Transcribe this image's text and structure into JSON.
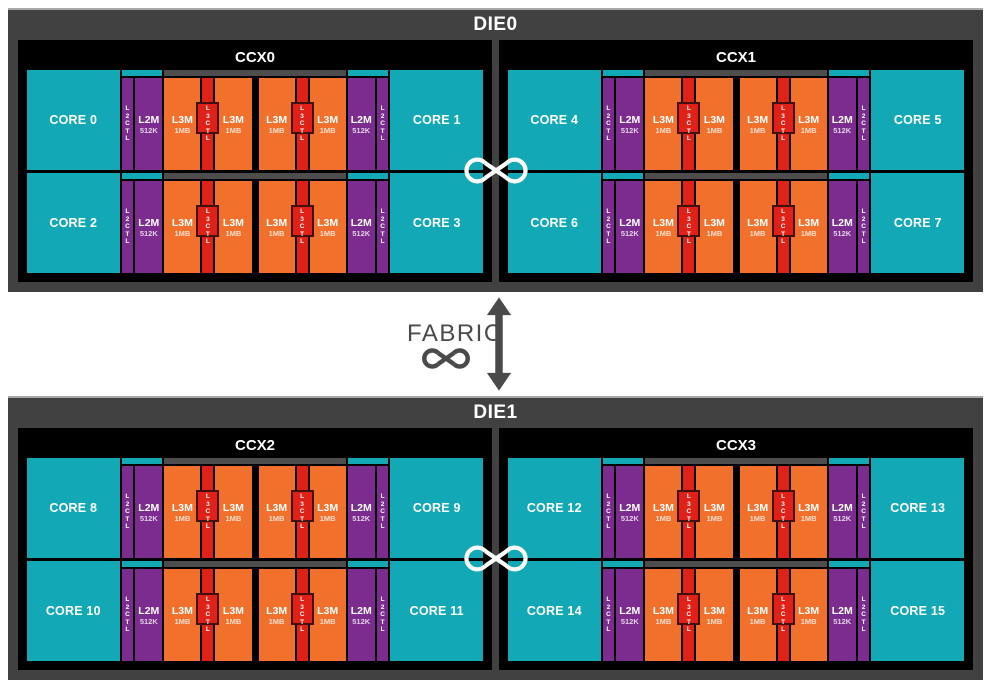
{
  "colors": {
    "teal": "#12a8b5",
    "purple": "#7b2c8e",
    "orange": "#f1702b",
    "red": "#e02117",
    "dark_red_border": "#43110c",
    "frame_gray": "#414141",
    "strip_gray": "#4d4d4d",
    "black": "#000000",
    "white": "#ffffff",
    "fabric_gray": "#4a4a4a"
  },
  "cache_labels": {
    "l2ctl": "L2CTL",
    "l2m": "L2M",
    "l2m_size": "512K",
    "l3m": "L3M",
    "l3m_size": "1MB",
    "l3ctl": "L3CTL"
  },
  "fabric": {
    "label": "FABRIC"
  },
  "dies": [
    {
      "label": "DIE0",
      "ccxs": [
        {
          "label": "CCX0",
          "rows": [
            {
              "cores": [
                "CORE 0",
                "CORE 1"
              ]
            },
            {
              "cores": [
                "CORE 2",
                "CORE 3"
              ]
            }
          ]
        },
        {
          "label": "CCX1",
          "rows": [
            {
              "cores": [
                "CORE 4",
                "CORE 5"
              ]
            },
            {
              "cores": [
                "CORE 6",
                "CORE 7"
              ]
            }
          ]
        }
      ]
    },
    {
      "label": "DIE1",
      "ccxs": [
        {
          "label": "CCX2",
          "rows": [
            {
              "cores": [
                "CORE 8",
                "CORE 9"
              ]
            },
            {
              "cores": [
                "CORE 10",
                "CORE 11"
              ]
            }
          ]
        },
        {
          "label": "CCX3",
          "rows": [
            {
              "cores": [
                "CORE 12",
                "CORE 13"
              ]
            },
            {
              "cores": [
                "CORE 14",
                "CORE 15"
              ]
            }
          ]
        }
      ]
    }
  ]
}
